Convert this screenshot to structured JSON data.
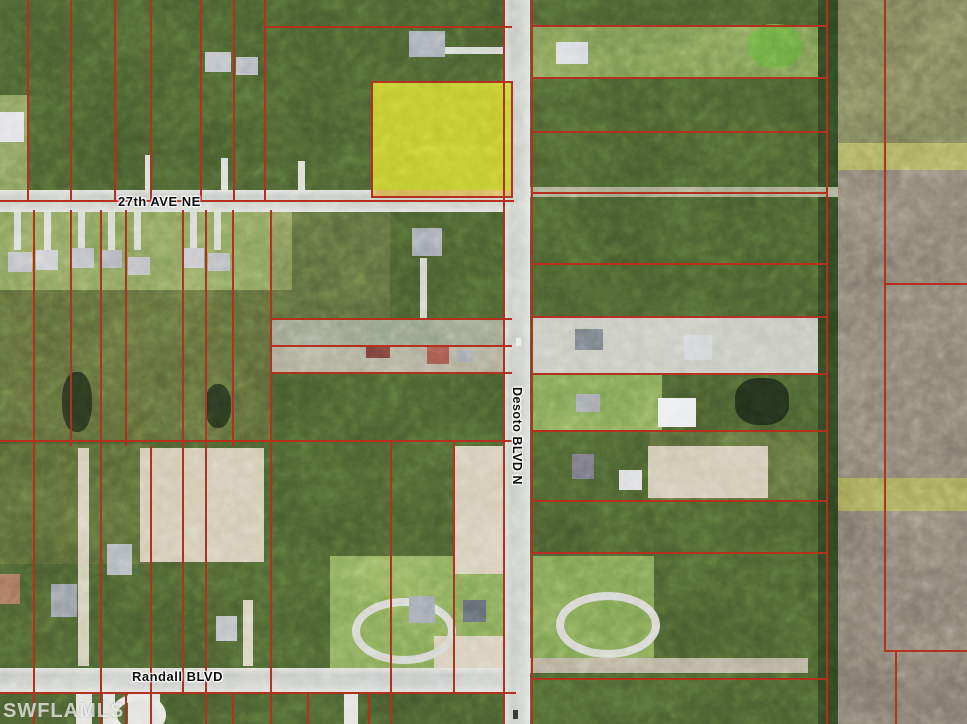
{
  "title": "Aerial parcel map - 27th Ave NE / Desoto Blvd N / Randall Blvd",
  "labels": {
    "ave27": "27th AVE NE",
    "desoto": "Desoto BLVD N",
    "randall": "Randall BLVD",
    "watermark": "SWFLAMLS"
  },
  "colors": {
    "parcel_line": "#b5301f",
    "highlight_parcel": "#c1ca2c",
    "road_paved": "#c6c9c2",
    "woods": "#44582c",
    "farm_field_brown": "#7e776a",
    "farm_field_olive": "#6f7350",
    "watermark": "rgba(250,250,245,0.72)"
  },
  "map": {
    "width": 967,
    "height": 724,
    "features": [
      {
        "n": "woods-base",
        "x": 0,
        "y": 0,
        "w": 838,
        "h": 724,
        "c": "#44582c",
        "cls": "tex-woods"
      },
      {
        "n": "left-lawn-strip",
        "x": 0,
        "y": 95,
        "w": 27,
        "h": 110,
        "c": "#7b9355"
      },
      {
        "n": "residential-lawn-row",
        "x": 0,
        "y": 212,
        "w": 292,
        "h": 78,
        "c": "#7d9755"
      },
      {
        "n": "scrub-left",
        "x": 0,
        "y": 290,
        "w": 272,
        "h": 152,
        "c": "#6a6c3e",
        "o": 0.5,
        "cls": "tex-scrub"
      },
      {
        "n": "scrub-mid",
        "x": 272,
        "y": 212,
        "w": 118,
        "h": 106,
        "c": "#70744a",
        "o": 0.4,
        "cls": "tex-scrub"
      },
      {
        "n": "marsh-strip",
        "x": 270,
        "y": 318,
        "w": 242,
        "h": 27,
        "c": "#909a80"
      },
      {
        "n": "farmstead-strip",
        "x": 270,
        "y": 345,
        "w": 242,
        "h": 27,
        "c": "#a6a58e"
      },
      {
        "n": "scrub-low-left",
        "x": 0,
        "y": 444,
        "w": 150,
        "h": 120,
        "c": "#6d6f42",
        "o": 0.35,
        "cls": "tex-scrub"
      },
      {
        "n": "sand-clearing",
        "x": 140,
        "y": 448,
        "w": 124,
        "h": 114,
        "c": "#cdc5ab",
        "cls": "tex-sand"
      },
      {
        "n": "lawn-randall-west",
        "x": 330,
        "y": 556,
        "w": 182,
        "h": 112,
        "c": "#7aa050"
      },
      {
        "n": "sand-desoto-west",
        "x": 455,
        "y": 446,
        "w": 58,
        "h": 128,
        "c": "#cfc7ae",
        "cls": "tex-sand"
      },
      {
        "n": "east-top-parcel",
        "x": 532,
        "y": 25,
        "w": 296,
        "h": 53,
        "c": "#74904e"
      },
      {
        "n": "east-cleared-strip",
        "x": 532,
        "y": 316,
        "w": 296,
        "h": 57,
        "c": "#c1c4b9"
      },
      {
        "n": "east-lawn-mid",
        "x": 532,
        "y": 374,
        "w": 130,
        "h": 58,
        "c": "#789c50"
      },
      {
        "n": "east-lawn-low",
        "x": 532,
        "y": 556,
        "w": 122,
        "h": 112,
        "c": "#75994d"
      },
      {
        "n": "scrub-east",
        "x": 650,
        "y": 430,
        "w": 176,
        "h": 70,
        "c": "#6f7446",
        "o": 0.4,
        "cls": "tex-scrub"
      },
      {
        "n": "sand-east",
        "x": 648,
        "y": 446,
        "w": 120,
        "h": 52,
        "c": "#cbc3a9",
        "cls": "tex-sand"
      },
      {
        "n": "sand-randall-corner",
        "x": 434,
        "y": 636,
        "w": 76,
        "h": 32,
        "c": "#cfc7ae",
        "cls": "tex-sand"
      },
      {
        "n": "treeline-strip",
        "x": 818,
        "y": 0,
        "w": 22,
        "h": 724,
        "c": "#2c3f1e",
        "cls": "tex-treeline"
      },
      {
        "n": "field-olive-north",
        "x": 838,
        "y": 0,
        "w": 129,
        "h": 143,
        "c": "#6f7350",
        "cls": "tex-field-v"
      },
      {
        "n": "field-band-north",
        "x": 838,
        "y": 143,
        "w": 129,
        "h": 27,
        "c": "#a4a458"
      },
      {
        "n": "field-brown-mid",
        "x": 838,
        "y": 170,
        "w": 129,
        "h": 308,
        "c": "#7e776a",
        "cls": "tex-field-v"
      },
      {
        "n": "field-band-south",
        "x": 838,
        "y": 478,
        "w": 129,
        "h": 33,
        "c": "#9c9c52"
      },
      {
        "n": "field-brown-south",
        "x": 838,
        "y": 511,
        "w": 129,
        "h": 213,
        "c": "#7a7367",
        "cls": "tex-field-v"
      },
      {
        "n": "road-27th-ave",
        "x": 0,
        "y": 190,
        "w": 516,
        "h": 22,
        "cls": "tex-road"
      },
      {
        "n": "road-randall",
        "x": 0,
        "y": 668,
        "w": 516,
        "h": 24,
        "cls": "tex-road"
      },
      {
        "n": "track-27th-east",
        "x": 516,
        "y": 187,
        "w": 322,
        "h": 10,
        "c": "#a9b08f",
        "o": 0.85
      },
      {
        "n": "road-randall-dirt-east",
        "x": 516,
        "y": 658,
        "w": 292,
        "h": 15,
        "c": "#b3ab95",
        "o": 0.95
      },
      {
        "n": "road-desoto",
        "x": 504,
        "y": 0,
        "w": 26,
        "h": 724,
        "cls": "tex-road-v"
      },
      {
        "n": "driveway",
        "x": 14,
        "y": 212,
        "w": 7,
        "h": 38,
        "c": "#d4d7d0"
      },
      {
        "n": "driveway",
        "x": 44,
        "y": 212,
        "w": 7,
        "h": 38,
        "c": "#d4d7d0"
      },
      {
        "n": "driveway",
        "x": 78,
        "y": 212,
        "w": 7,
        "h": 38,
        "c": "#d4d7d0"
      },
      {
        "n": "driveway",
        "x": 108,
        "y": 212,
        "w": 7,
        "h": 38,
        "c": "#d4d7d0"
      },
      {
        "n": "driveway",
        "x": 134,
        "y": 212,
        "w": 7,
        "h": 38,
        "c": "#d4d7d0"
      },
      {
        "n": "driveway",
        "x": 190,
        "y": 212,
        "w": 7,
        "h": 38,
        "c": "#d4d7d0"
      },
      {
        "n": "driveway",
        "x": 214,
        "y": 212,
        "w": 7,
        "h": 38,
        "c": "#d4d7d0"
      },
      {
        "n": "driveway",
        "x": 145,
        "y": 155,
        "w": 7,
        "h": 36,
        "c": "#d8dbd3"
      },
      {
        "n": "driveway",
        "x": 221,
        "y": 158,
        "w": 7,
        "h": 34,
        "c": "#d8dbd3"
      },
      {
        "n": "driveway",
        "x": 298,
        "y": 161,
        "w": 7,
        "h": 30,
        "c": "#d8dbd3"
      },
      {
        "n": "driveway",
        "x": 441,
        "y": 47,
        "w": 64,
        "h": 7,
        "c": "#d2d5cd"
      },
      {
        "n": "driveway",
        "x": 420,
        "y": 258,
        "w": 7,
        "h": 62,
        "c": "#cfd2ca"
      },
      {
        "n": "driveway-long",
        "x": 78,
        "y": 448,
        "w": 11,
        "h": 218,
        "c": "#cfc8b2"
      },
      {
        "n": "driveway-long",
        "x": 243,
        "y": 600,
        "w": 10,
        "h": 66,
        "c": "#cfc8b2"
      },
      {
        "n": "circular-driveway",
        "x": 352,
        "y": 598,
        "w": 104,
        "h": 66,
        "b": 1,
        "bw": 8,
        "c": "#d0d3ca",
        "rad": "50%"
      },
      {
        "n": "circular-driveway",
        "x": 556,
        "y": 592,
        "w": 104,
        "h": 66,
        "b": 1,
        "bw": 8,
        "c": "#d0d3ca",
        "rad": "50%"
      },
      {
        "n": "street-stub",
        "x": 76,
        "y": 690,
        "w": 16,
        "h": 34,
        "c": "#dedfd9"
      },
      {
        "n": "street-stub",
        "x": 103,
        "y": 692,
        "w": 12,
        "h": 32,
        "c": "#dedfd9"
      },
      {
        "n": "street-stub",
        "x": 128,
        "y": 694,
        "w": 32,
        "h": 30,
        "c": "#dedfd9"
      },
      {
        "n": "cul-de-sac-loop",
        "x": 110,
        "y": 694,
        "w": 56,
        "h": 42,
        "b": 1,
        "bw": 7,
        "c": "#e2e4de",
        "rad": "50%"
      },
      {
        "n": "street-stub",
        "x": 344,
        "y": 690,
        "w": 14,
        "h": 34,
        "c": "#dedfd9"
      },
      {
        "n": "pond",
        "x": 62,
        "y": 372,
        "w": 30,
        "h": 60,
        "c": "#26331c",
        "rad": "45%"
      },
      {
        "n": "pond",
        "x": 205,
        "y": 384,
        "w": 26,
        "h": 44,
        "c": "#26331c",
        "rad": "45%"
      },
      {
        "n": "pond-green",
        "x": 748,
        "y": 24,
        "w": 54,
        "h": 44,
        "c": "#64a23d",
        "rad": "45%"
      },
      {
        "n": "pond",
        "x": 735,
        "y": 378,
        "w": 54,
        "h": 47,
        "c": "#1f2b18",
        "rad": "42%"
      },
      {
        "n": "house",
        "x": 205,
        "y": 52,
        "w": 26,
        "h": 20,
        "c": "#b7babf"
      },
      {
        "n": "house",
        "x": 236,
        "y": 57,
        "w": 22,
        "h": 18,
        "c": "#aeb2b8"
      },
      {
        "n": "house",
        "x": 0,
        "y": 112,
        "w": 24,
        "h": 30,
        "c": "#dcdfe1"
      },
      {
        "n": "house",
        "x": 409,
        "y": 31,
        "w": 36,
        "h": 26,
        "c": "#9aa1a9"
      },
      {
        "n": "house",
        "x": 556,
        "y": 42,
        "w": 32,
        "h": 22,
        "c": "#d3d6d9"
      },
      {
        "n": "house",
        "x": 8,
        "y": 252,
        "w": 24,
        "h": 20,
        "c": "#b4b8bd"
      },
      {
        "n": "house",
        "x": 36,
        "y": 250,
        "w": 22,
        "h": 20,
        "c": "#c0c3c7"
      },
      {
        "n": "house",
        "x": 72,
        "y": 248,
        "w": 22,
        "h": 20,
        "c": "#b7babf"
      },
      {
        "n": "house",
        "x": 102,
        "y": 250,
        "w": 20,
        "h": 18,
        "c": "#adb1b6"
      },
      {
        "n": "house",
        "x": 128,
        "y": 257,
        "w": 22,
        "h": 18,
        "c": "#b7babf"
      },
      {
        "n": "house",
        "x": 184,
        "y": 248,
        "w": 20,
        "h": 20,
        "c": "#c0c3c7"
      },
      {
        "n": "house",
        "x": 208,
        "y": 253,
        "w": 22,
        "h": 18,
        "c": "#b0b4b9"
      },
      {
        "n": "house",
        "x": 412,
        "y": 228,
        "w": 30,
        "h": 28,
        "c": "#99a0a8"
      },
      {
        "n": "outbuilding",
        "x": 366,
        "y": 345,
        "w": 24,
        "h": 13,
        "c": "#6d3b32"
      },
      {
        "n": "house",
        "x": 427,
        "y": 347,
        "w": 22,
        "h": 17,
        "c": "#9c5146"
      },
      {
        "n": "outbuilding",
        "x": 457,
        "y": 350,
        "w": 16,
        "h": 12,
        "c": "#9aa0a5"
      },
      {
        "n": "house",
        "x": 575,
        "y": 329,
        "w": 28,
        "h": 21,
        "c": "#70767c"
      },
      {
        "n": "house",
        "x": 684,
        "y": 335,
        "w": 28,
        "h": 25,
        "c": "#ccd0d3"
      },
      {
        "n": "house",
        "x": 576,
        "y": 394,
        "w": 24,
        "h": 18,
        "c": "#9da3a8"
      },
      {
        "n": "house",
        "x": 658,
        "y": 398,
        "w": 38,
        "h": 29,
        "c": "#e9ebec"
      },
      {
        "n": "house",
        "x": 572,
        "y": 454,
        "w": 22,
        "h": 25,
        "c": "#6c6a76"
      },
      {
        "n": "outbuilding",
        "x": 619,
        "y": 470,
        "w": 23,
        "h": 20,
        "c": "#d9dbdd"
      },
      {
        "n": "house",
        "x": 0,
        "y": 574,
        "w": 20,
        "h": 30,
        "c": "#9b6a54"
      },
      {
        "n": "house",
        "x": 51,
        "y": 584,
        "w": 26,
        "h": 33,
        "c": "#8b929b"
      },
      {
        "n": "house",
        "x": 107,
        "y": 544,
        "w": 25,
        "h": 31,
        "c": "#aab0b5"
      },
      {
        "n": "house",
        "x": 216,
        "y": 616,
        "w": 21,
        "h": 25,
        "c": "#b2b6bb"
      },
      {
        "n": "house",
        "x": 409,
        "y": 596,
        "w": 26,
        "h": 27,
        "c": "#8f98a1"
      },
      {
        "n": "house",
        "x": 463,
        "y": 600,
        "w": 23,
        "h": 22,
        "c": "#5e666e"
      },
      {
        "n": "vehicle",
        "x": 513,
        "y": 710,
        "w": 5,
        "h": 9,
        "c": "#2f2f2f"
      },
      {
        "n": "vehicle",
        "x": 516,
        "y": 338,
        "w": 5,
        "h": 8,
        "c": "#eaeaea"
      },
      {
        "n": "highlighted-parcel",
        "x": 372,
        "y": 82,
        "w": 140,
        "h": 115,
        "c": "#c1ca2c",
        "o": 0.94,
        "cls": "tex-hl"
      },
      {
        "n": "highlight-dirt-edge",
        "x": 372,
        "y": 190,
        "w": 140,
        "h": 7,
        "c": "#d2a95b",
        "o": 0.85
      }
    ],
    "parcel_lines": [
      [
        27,
        0,
        2,
        202
      ],
      [
        70,
        0,
        2,
        202
      ],
      [
        114,
        0,
        2,
        202
      ],
      [
        150,
        0,
        2,
        202
      ],
      [
        200,
        0,
        2,
        202
      ],
      [
        233,
        0,
        2,
        202
      ],
      [
        264,
        0,
        2,
        202
      ],
      [
        264,
        26,
        248,
        2
      ],
      [
        0,
        200,
        514,
        2
      ],
      [
        33,
        210,
        2,
        236
      ],
      [
        70,
        210,
        2,
        236
      ],
      [
        100,
        210,
        2,
        236
      ],
      [
        125,
        210,
        2,
        236
      ],
      [
        182,
        210,
        2,
        236
      ],
      [
        205,
        210,
        2,
        236
      ],
      [
        232,
        210,
        2,
        236
      ],
      [
        270,
        210,
        2,
        236
      ],
      [
        270,
        318,
        242,
        2
      ],
      [
        270,
        345,
        242,
        2
      ],
      [
        270,
        372,
        242,
        2
      ],
      [
        0,
        440,
        512,
        2
      ],
      [
        33,
        446,
        2,
        278
      ],
      [
        100,
        446,
        2,
        278
      ],
      [
        150,
        446,
        2,
        278
      ],
      [
        182,
        446,
        2,
        246
      ],
      [
        205,
        446,
        2,
        278
      ],
      [
        270,
        446,
        2,
        278
      ],
      [
        390,
        440,
        2,
        284
      ],
      [
        453,
        440,
        2,
        252
      ],
      [
        0,
        692,
        516,
        2
      ],
      [
        125,
        694,
        2,
        30
      ],
      [
        232,
        694,
        2,
        30
      ],
      [
        307,
        694,
        2,
        30
      ],
      [
        368,
        694,
        2,
        30
      ],
      [
        503,
        0,
        2,
        724
      ],
      [
        531,
        0,
        2,
        724
      ],
      [
        531,
        25,
        297,
        2
      ],
      [
        531,
        77,
        297,
        2
      ],
      [
        531,
        131,
        297,
        2
      ],
      [
        531,
        192,
        297,
        2
      ],
      [
        531,
        263,
        297,
        2
      ],
      [
        531,
        316,
        297,
        2
      ],
      [
        531,
        373,
        297,
        2
      ],
      [
        531,
        430,
        297,
        2
      ],
      [
        531,
        500,
        297,
        2
      ],
      [
        531,
        552,
        297,
        2
      ],
      [
        531,
        678,
        297,
        2
      ],
      [
        826,
        0,
        2,
        724
      ],
      [
        884,
        0,
        2,
        652
      ],
      [
        884,
        283,
        83,
        2
      ],
      [
        884,
        650,
        83,
        2
      ],
      [
        895,
        652,
        2,
        72
      ]
    ],
    "overlay_features": [
      {
        "n": "highlighted-parcel-border",
        "x": 371,
        "y": 81,
        "w": 142,
        "h": 117,
        "b": 1,
        "bw": 2,
        "c": "#b5301f"
      }
    ]
  }
}
